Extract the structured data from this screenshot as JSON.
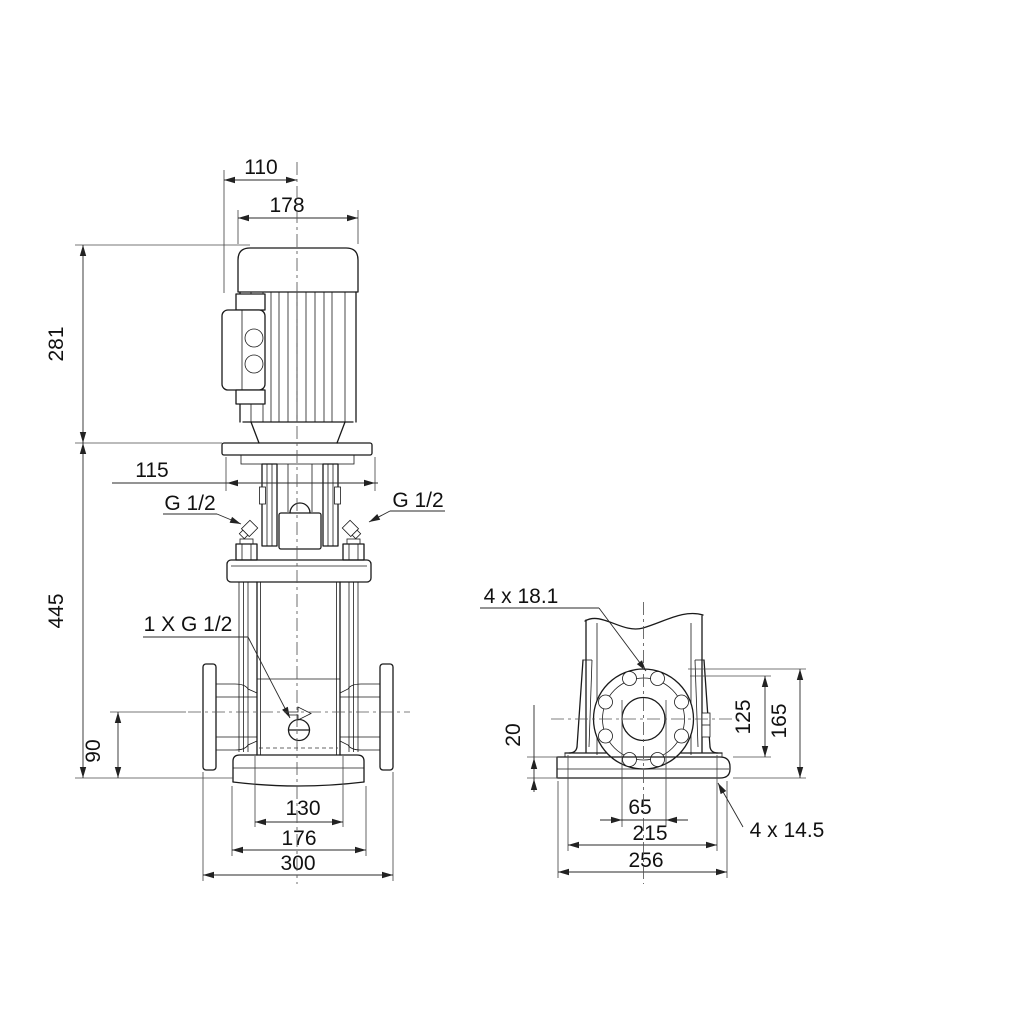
{
  "colors": {
    "line": "#1a1a1a",
    "dim": "#2a2a2a",
    "background": "#ffffff"
  },
  "front_view": {
    "fan_cover_width": "110",
    "motor_width": "178",
    "motor_height": "281",
    "stool_width": "115",
    "pump_height": "445",
    "port_height": "90",
    "chamber_width": "130",
    "base_width": "176",
    "port_to_port": "300",
    "gauge_port_left": "G 1/2",
    "gauge_port_right": "G 1/2",
    "drain_port": "1 X G 1/2"
  },
  "side_view": {
    "flange_holes": "4 x 18.1",
    "base_thickness": "20",
    "port_bore": "65",
    "hole_center_height": "125",
    "flange_top_height": "165",
    "foot_hole_spacing": "215",
    "base_length": "256",
    "base_holes": "4 x 14.5"
  }
}
